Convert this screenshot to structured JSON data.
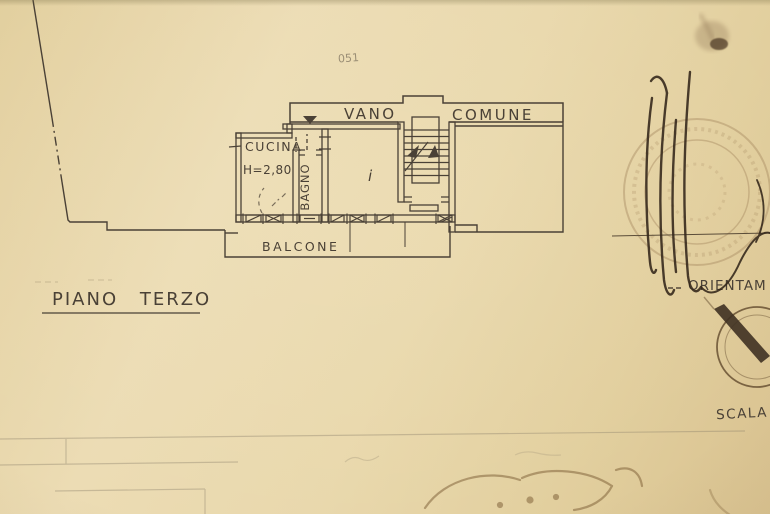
{
  "document": {
    "type": "scanned architectural floor plan photograph",
    "floor_title": "PIANO TERZO",
    "faint_note": "051"
  },
  "plan": {
    "corridor": {
      "label_left": "VANO",
      "label_right": "COMUNE"
    },
    "rooms": {
      "kitchen": {
        "label": "CUCINA",
        "height_note": "H=2,80"
      },
      "bathroom": {
        "label": "BAGNO"
      },
      "main_room_mark": "i"
    },
    "balcony": {
      "label": "BALCONE"
    }
  },
  "annotations": {
    "orientation_label": "ORIENTAM",
    "scale_label": "SCALA"
  },
  "colors": {
    "paper": "#e9d8ac",
    "ink": "#4a4136",
    "stamp": "#a98c63",
    "signature": "#33261a"
  }
}
